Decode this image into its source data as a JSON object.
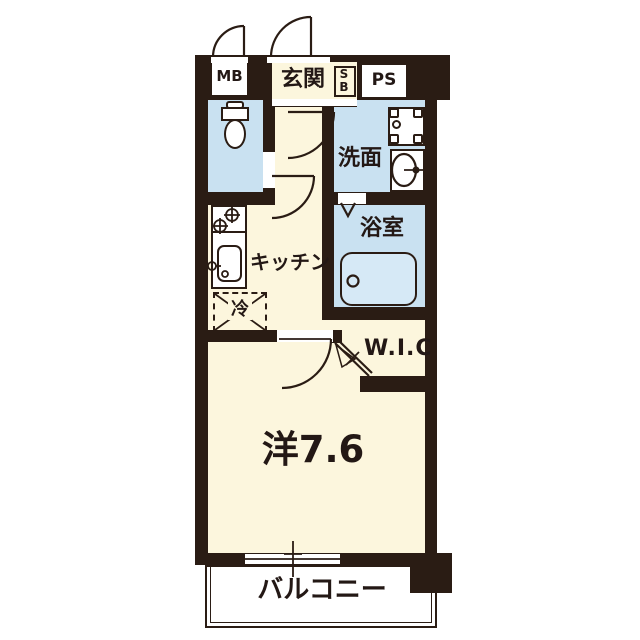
{
  "floorplan": {
    "units": {
      "mb": "MB",
      "entrance": "玄関",
      "shoebox_line1": "S",
      "shoebox_line2": "B",
      "pipe_space": "PS",
      "washroom": "洗面",
      "bathroom": "浴室",
      "kitchen": "キッチン",
      "refrigerator": "冷",
      "walk_in_closet": "W.I.C",
      "main_room": "洋7.6",
      "balcony": "バルコニー"
    },
    "colors": {
      "wall": "#2a1c14",
      "floor_cream": "#fcf6dd",
      "floor_wet": "#c9e1f1",
      "bathtub": "#d6e9f6",
      "white": "#ffffff"
    }
  }
}
